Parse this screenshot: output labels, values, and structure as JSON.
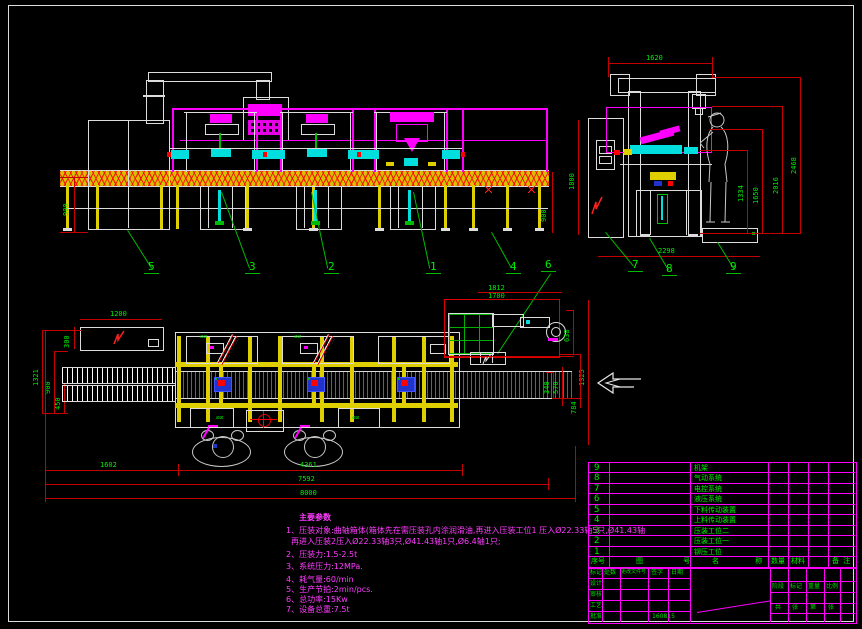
{
  "front_view": {
    "dim_left_height": "900",
    "dim_right_height": "900",
    "labels": {
      "l5": "5",
      "l3": "3",
      "l2": "2",
      "l1": "1",
      "l4": "4",
      "l6": "6"
    }
  },
  "side_view": {
    "dims": {
      "width_top": "1620",
      "h1334": "1334",
      "h1650": "1650",
      "h2016": "2016",
      "h2468": "2468",
      "width_bottom": "2298",
      "h1800": "1800"
    },
    "labels": {
      "l7": "7",
      "l8": "8",
      "l9": "9"
    }
  },
  "plan_view": {
    "dims": {
      "cabinet_width": "1200",
      "cabinet_depth": "300",
      "d1321": "1321",
      "d900": "900",
      "d450": "450",
      "d1812": "1812",
      "d1700": "1700",
      "d638": "638",
      "d1325": "1325",
      "d340": "340",
      "d570": "570",
      "d784": "784",
      "d1602": "1602",
      "d4361": "4361",
      "d7592": "7592",
      "d8000": "8000"
    },
    "station_marks": "⌀⌀"
  },
  "notes": {
    "title": "主要参数",
    "lines": [
      "1、压装对象:曲轴箱体(箱体先在需压装孔内涂润滑油,再进入压装工位1 压入Ø22.33轴5只,Ø41.43轴",
      "再进入压装2压入Ø22.33轴3只,Ø41.43轴1只,Ø6.4轴1只;",
      "2、压装力:1.5-2.5t",
      "3、系统压力:12MPa.",
      "4、耗气量:60/min",
      "5、生产节拍:2min/pcs.",
      "6、总功率:15Kw",
      "7、设备总重:7.5t"
    ]
  },
  "bom": {
    "headers": [
      "序号",
      "图 号",
      "名 称",
      "数量",
      "材料",
      "备 注"
    ],
    "rows": [
      {
        "no": "9",
        "name": "机架"
      },
      {
        "no": "8",
        "name": "气动系统"
      },
      {
        "no": "7",
        "name": "电控系统"
      },
      {
        "no": "6",
        "name": "液压系统"
      },
      {
        "no": "5",
        "name": "下料传动装置"
      },
      {
        "no": "4",
        "name": "上料传动装置"
      },
      {
        "no": "3",
        "name": "压装工位二"
      },
      {
        "no": "2",
        "name": "压装工位一"
      },
      {
        "no": "1",
        "name": "铆压工位"
      }
    ]
  },
  "titleblock": {
    "cols": [
      "标记",
      "处数",
      "更改文件号",
      "签字",
      "日期"
    ],
    "signs": [
      "设计",
      "审核",
      "工艺",
      "批准"
    ],
    "date": "160815",
    "stage": [
      "阶段",
      "标记",
      "重量",
      "比例"
    ],
    "sheet": [
      "共",
      "张",
      "第",
      "张"
    ]
  }
}
